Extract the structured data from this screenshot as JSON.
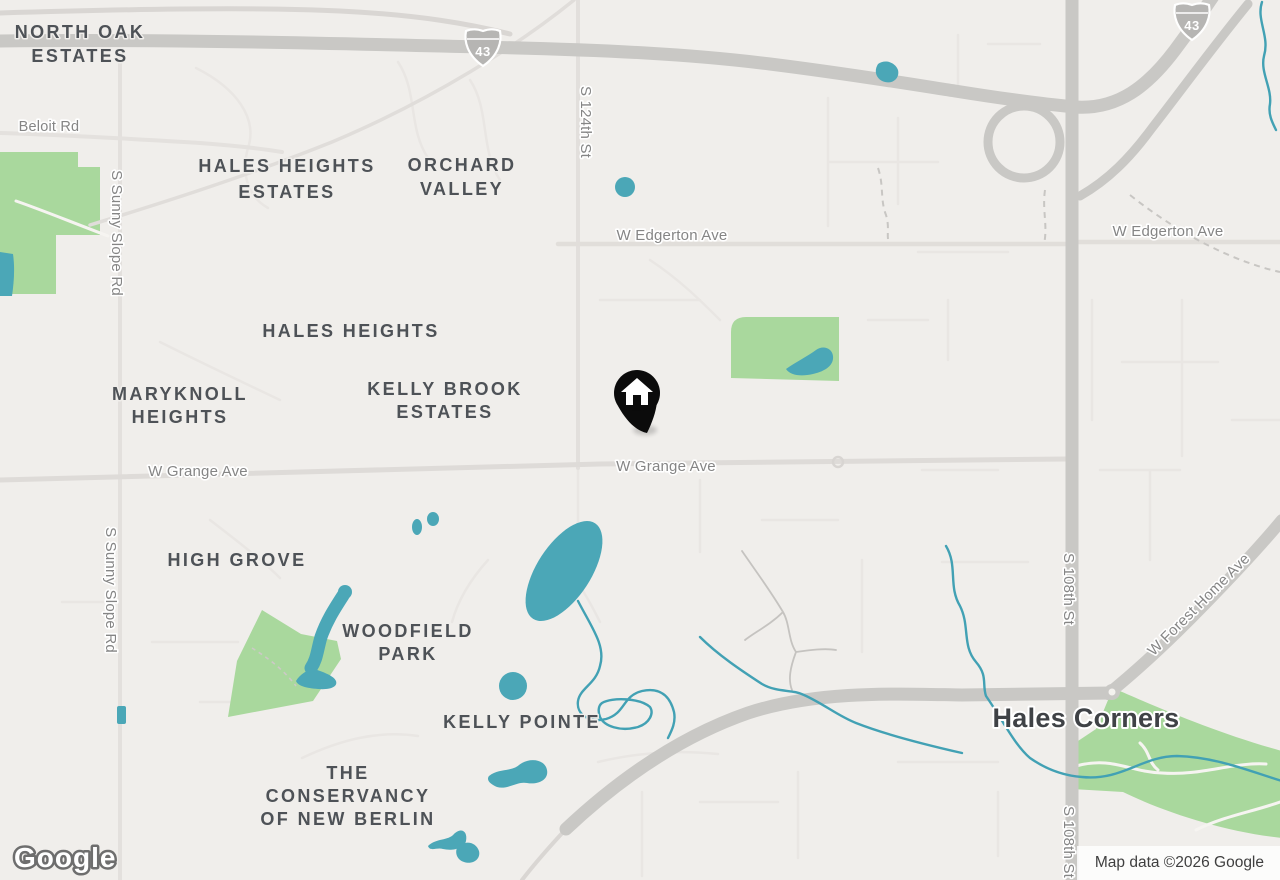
{
  "map_type": "roadmap",
  "attribution": {
    "logo": "Google",
    "text": "Map data ©2026 Google"
  },
  "marker": {
    "kind": "home-location-pin",
    "color": "#0b0b0b",
    "glyph": "house"
  },
  "shields": {
    "interstate_43": "43"
  },
  "labels": {
    "city": {
      "hales_corners": "Hales Corners"
    },
    "neighborhoods": {
      "north_oak_estates": [
        "NORTH OAK",
        "ESTATES"
      ],
      "hales_heights_estates": [
        "HALES HEIGHTS",
        "ESTATES"
      ],
      "orchard_valley": [
        "ORCHARD",
        "VALLEY"
      ],
      "hales_heights": [
        "HALES HEIGHTS"
      ],
      "maryknoll_heights": [
        "MARYKNOLL",
        "HEIGHTS"
      ],
      "kelly_brook_estates": [
        "KELLY BROOK",
        "ESTATES"
      ],
      "high_grove": [
        "HIGH GROVE"
      ],
      "woodfield_park": [
        "WOODFIELD",
        "PARK"
      ],
      "kelly_pointe": [
        "KELLY POINTE"
      ],
      "the_conservancy_of_new_berlin": [
        "THE",
        "CONSERVANCY",
        "OF NEW BERLIN"
      ]
    },
    "roads": {
      "beloit_rd": "Beloit Rd",
      "s_sunny_slope_rd": "S Sunny Slope Rd",
      "s_124th_st": "S 124th St",
      "w_edgerton_ave": "W Edgerton Ave",
      "w_grange_ave": "W Grange Ave",
      "s_108th_st": "S 108th St",
      "w_forest_home_ave": "W Forest Home Ave"
    }
  },
  "colors": {
    "background": "#f0eeeb",
    "park_green": "#a9d89d",
    "water_teal": "#4ba7b7",
    "stream_blue": "#42a1b4",
    "major_road": "#c9c8c5",
    "minor_road": "#e8e5e2",
    "area_label": "#4e5257",
    "road_label": "#858585",
    "city_label": "#3f4246",
    "marker_black": "#0b0b0b"
  }
}
